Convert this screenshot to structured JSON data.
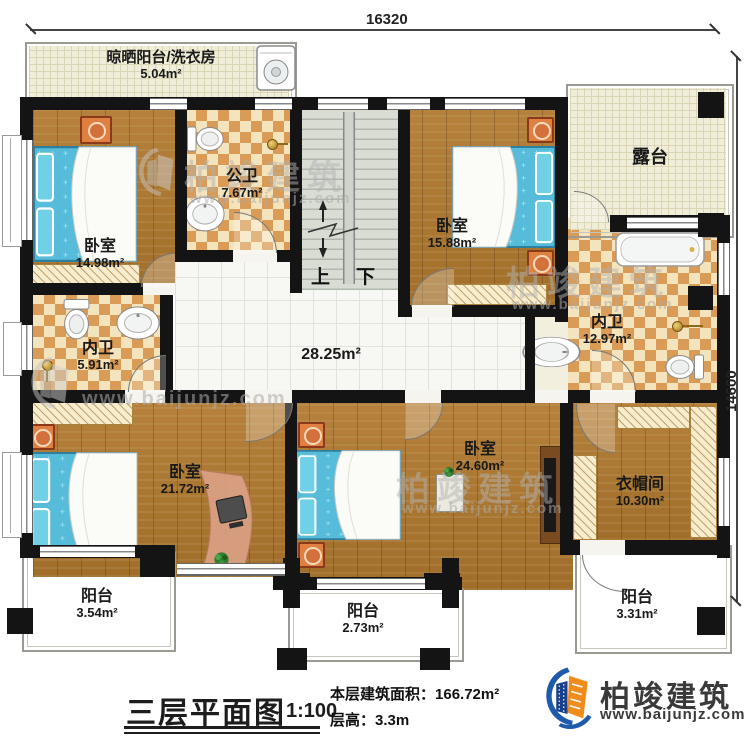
{
  "dimensions": {
    "top": "16320",
    "right": "14600"
  },
  "rooms": {
    "laundry": {
      "name": "晾晒阳台/洗衣房",
      "area": "5.04m²"
    },
    "public_bath": {
      "name": "公卫",
      "area": "7.67m²"
    },
    "bedroom_nw": {
      "name": "卧室",
      "area": "14.98m²"
    },
    "bedroom_ne": {
      "name": "卧室",
      "area": "15.88m²"
    },
    "terrace": {
      "name": "露台"
    },
    "ensuite_east": {
      "name": "内卫",
      "area": "12.97m²"
    },
    "ensuite_west": {
      "name": "内卫",
      "area": "5.91m²"
    },
    "hall": {
      "area": "28.25m²"
    },
    "bedroom_sw": {
      "name": "卧室",
      "area": "21.72m²"
    },
    "bedroom_s": {
      "name": "卧室",
      "area": "24.60m²"
    },
    "cloakroom": {
      "name": "衣帽间",
      "area": "10.30m²"
    },
    "balcony_sw": {
      "name": "阳台",
      "area": "3.54m²"
    },
    "balcony_s": {
      "name": "阳台",
      "area": "2.73m²"
    },
    "balcony_se": {
      "name": "阳台",
      "area": "3.31m²"
    }
  },
  "stairs": {
    "up": "上",
    "down": "下"
  },
  "title_block": {
    "title": "三层平面图",
    "scale": "1:100",
    "area_label": "本层建筑面积：",
    "area_value": "166.72m²",
    "height_label": "层高：",
    "height_value": "3.3m"
  },
  "brand": {
    "name": "柏竣建筑",
    "website": "www.baijunjz.com"
  },
  "watermark": {
    "name": "柏竣建筑",
    "website": "www.baijunjz.com"
  },
  "colors": {
    "wall": "#141414",
    "wood": "#ad7a33",
    "tile_tan": "#d99b55",
    "tile_cream": "#f4e4bd",
    "balcony_floor": "#f0edd8",
    "bed_blue": "#57bcd9",
    "bedside_orange": "#e08040",
    "brand_blue": "#1e5bad",
    "brand_orange": "#f08c1c"
  }
}
